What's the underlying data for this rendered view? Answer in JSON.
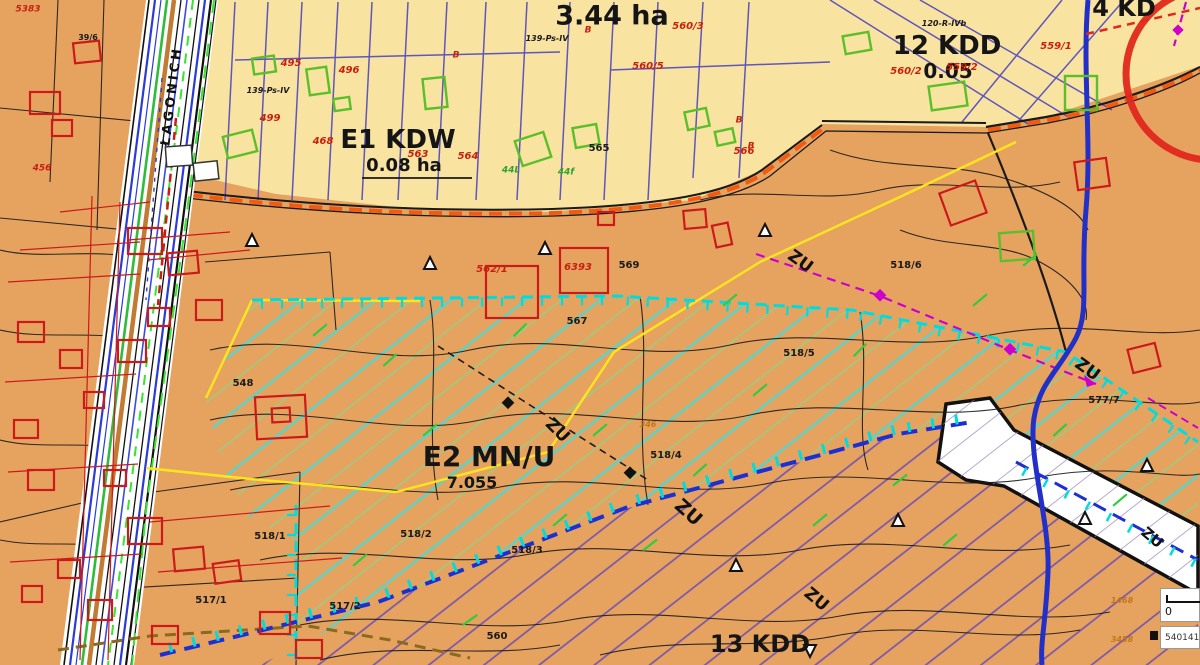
{
  "map_title": "zoning-plan-map",
  "colors": {
    "base_orange": "#E6A360",
    "zone_yellow": "#F8E3A0",
    "hatch_teal": "#5FD2C4",
    "hatch_green": "#8CD489",
    "hatch_purple": "#7B57A8",
    "boundary_yellow": "#FFE51E",
    "dashed_cyan": "#00DCDC",
    "dashed_blue": "#1D2FD0",
    "magenta": "#CC00CC",
    "river_blue": "#2230C8",
    "road_orange_dash": "#F25A10",
    "building_red": "#CC1A1A",
    "building_green": "#5BBF2A",
    "parcel_indigo": "#4F46C0",
    "road_green": "#2EBD3A",
    "road_brown": "#C27B32"
  },
  "scale_widget": {
    "zero": "0",
    "coordinate": "540141"
  },
  "labels": [
    {
      "name": "zone-label-344ha",
      "text": "3.44 ha",
      "x": 612,
      "y": 16,
      "size": 27,
      "color": "#151515",
      "weight": 700
    },
    {
      "name": "zone-label-12kdd",
      "text": "12 KDD",
      "x": 947,
      "y": 46,
      "size": 26,
      "color": "#151515",
      "weight": 700
    },
    {
      "name": "zone-label-12kdd-area",
      "text": "0.05",
      "x": 948,
      "y": 71,
      "size": 20,
      "color": "#151515",
      "weight": 700
    },
    {
      "name": "zone-label-e1kdw",
      "text": "E1 KDW",
      "x": 398,
      "y": 140,
      "size": 26,
      "color": "#151515",
      "weight": 700
    },
    {
      "name": "zone-label-e1kdw-area",
      "text": "0.08 ha",
      "x": 404,
      "y": 166,
      "size": 18,
      "color": "#151515",
      "weight": 700
    },
    {
      "name": "zone-label-e2mnu",
      "text": "E2 MN/U",
      "x": 489,
      "y": 457,
      "size": 28,
      "color": "#151515",
      "weight": 700
    },
    {
      "name": "zone-label-e2mnu-area",
      "text": "7.055",
      "x": 472,
      "y": 483,
      "size": 16,
      "color": "#151515",
      "weight": 700
    },
    {
      "name": "zone-label-13kdd",
      "text": "13 KDD",
      "x": 760,
      "y": 644,
      "size": 24,
      "color": "#151515",
      "weight": 700
    },
    {
      "name": "zone-label-4kd",
      "text": "4 KD",
      "x": 1124,
      "y": 8,
      "size": 24,
      "color": "#151515",
      "weight": 700
    },
    {
      "name": "zu-label",
      "text": "ZU",
      "x": 800,
      "y": 262,
      "size": 17,
      "color": "#111111",
      "weight": 700,
      "rot": 36
    },
    {
      "name": "zu-label",
      "text": "ZU",
      "x": 1087,
      "y": 370,
      "size": 17,
      "color": "#111111",
      "weight": 700,
      "rot": 36
    },
    {
      "name": "zu-label",
      "text": "ZU",
      "x": 557,
      "y": 431,
      "size": 17,
      "color": "#111111",
      "weight": 700,
      "rot": 45
    },
    {
      "name": "zu-label",
      "text": "ZU",
      "x": 688,
      "y": 513,
      "size": 19,
      "color": "#111111",
      "weight": 700,
      "rot": 42
    },
    {
      "name": "zu-label",
      "text": "ZU",
      "x": 816,
      "y": 600,
      "size": 17,
      "color": "#111111",
      "weight": 700,
      "rot": 40
    },
    {
      "name": "zu-label",
      "text": "ZU",
      "x": 1152,
      "y": 538,
      "size": 15,
      "color": "#111111",
      "weight": 700,
      "rot": 40
    },
    {
      "name": "street-name",
      "text": "ŁAGONICH",
      "x": 172,
      "y": 96,
      "size": 13,
      "color": "#111111",
      "weight": 700,
      "rot": -83,
      "ls": 3
    },
    {
      "name": "parcel-label",
      "text": "560/3",
      "x": 688,
      "y": 27,
      "size": 10,
      "color": "#C82010",
      "italic": true,
      "weight": 600
    },
    {
      "name": "parcel-label",
      "text": "560/5",
      "x": 648,
      "y": 67,
      "size": 10,
      "color": "#C82010",
      "italic": true,
      "weight": 600
    },
    {
      "name": "parcel-label",
      "text": "559/1",
      "x": 1056,
      "y": 47,
      "size": 10,
      "color": "#C82010",
      "italic": true,
      "weight": 600
    },
    {
      "name": "parcel-label",
      "text": "559/2",
      "x": 962,
      "y": 68,
      "size": 10,
      "color": "#C82010",
      "italic": true,
      "weight": 600
    },
    {
      "name": "parcel-label",
      "text": "560/2",
      "x": 906,
      "y": 72,
      "size": 10,
      "color": "#C82010",
      "italic": true,
      "weight": 600
    },
    {
      "name": "parcel-label",
      "text": "563",
      "x": 418,
      "y": 155,
      "size": 10,
      "color": "#C82010",
      "italic": true,
      "weight": 600
    },
    {
      "name": "parcel-label",
      "text": "564",
      "x": 468,
      "y": 157,
      "size": 10,
      "color": "#C82010",
      "italic": true,
      "weight": 600
    },
    {
      "name": "parcel-label",
      "text": "566",
      "x": 744,
      "y": 152,
      "size": 10,
      "color": "#C82010",
      "italic": true,
      "weight": 600
    },
    {
      "name": "parcel-label",
      "text": "495",
      "x": 291,
      "y": 64,
      "size": 10,
      "color": "#C82010",
      "italic": true,
      "weight": 600
    },
    {
      "name": "parcel-label",
      "text": "496",
      "x": 349,
      "y": 71,
      "size": 10,
      "color": "#C82010",
      "italic": true,
      "weight": 600
    },
    {
      "name": "parcel-label",
      "text": "499",
      "x": 270,
      "y": 119,
      "size": 10,
      "color": "#C82010",
      "italic": true,
      "weight": 600
    },
    {
      "name": "parcel-label",
      "text": "468",
      "x": 323,
      "y": 142,
      "size": 10,
      "color": "#C82010",
      "italic": true,
      "weight": 600
    },
    {
      "name": "parcel-label",
      "text": "6393",
      "x": 578,
      "y": 268,
      "size": 10,
      "color": "#C82010",
      "italic": true,
      "weight": 600
    },
    {
      "name": "parcel-label",
      "text": "562/1",
      "x": 492,
      "y": 270,
      "size": 10,
      "color": "#C82010",
      "italic": true,
      "weight": 600
    },
    {
      "name": "parcel-label",
      "text": "5383",
      "x": 28,
      "y": 10,
      "size": 9,
      "color": "#C82010",
      "italic": true,
      "weight": 600
    },
    {
      "name": "parcel-label",
      "text": "456",
      "x": 42,
      "y": 169,
      "size": 9,
      "color": "#C82010",
      "italic": true,
      "weight": 600
    },
    {
      "name": "building-class-label",
      "text": "B",
      "x": 456,
      "y": 56,
      "size": 9,
      "color": "#C82010",
      "italic": true,
      "weight": 600
    },
    {
      "name": "building-class-label",
      "text": "B",
      "x": 588,
      "y": 31,
      "size": 9,
      "color": "#C82010",
      "italic": true,
      "weight": 600
    },
    {
      "name": "building-class-label",
      "text": "B",
      "x": 739,
      "y": 121,
      "size": 9,
      "color": "#C82010",
      "italic": true,
      "weight": 600
    },
    {
      "name": "building-class-label",
      "text": "B",
      "x": 751,
      "y": 147,
      "size": 9,
      "color": "#C82010",
      "italic": true,
      "weight": 600
    },
    {
      "name": "parcel-label",
      "text": "567",
      "x": 577,
      "y": 322,
      "size": 10,
      "color": "#1a1a1a",
      "weight": 700
    },
    {
      "name": "parcel-label",
      "text": "569",
      "x": 629,
      "y": 266,
      "size": 10,
      "color": "#1a1a1a",
      "weight": 700
    },
    {
      "name": "parcel-label",
      "text": "565",
      "x": 599,
      "y": 149,
      "size": 10,
      "color": "#1a1a1a",
      "weight": 700
    },
    {
      "name": "parcel-label",
      "text": "548",
      "x": 243,
      "y": 384,
      "size": 10,
      "color": "#1a1a1a",
      "weight": 700
    },
    {
      "name": "parcel-label",
      "text": "518/6",
      "x": 906,
      "y": 266,
      "size": 10,
      "color": "#1a1a1a",
      "weight": 700
    },
    {
      "name": "parcel-label",
      "text": "518/5",
      "x": 799,
      "y": 354,
      "size": 10,
      "color": "#1a1a1a",
      "weight": 700
    },
    {
      "name": "parcel-label",
      "text": "518/4",
      "x": 666,
      "y": 456,
      "size": 10,
      "color": "#1a1a1a",
      "weight": 700
    },
    {
      "name": "parcel-label",
      "text": "518/3",
      "x": 527,
      "y": 551,
      "size": 10,
      "color": "#1a1a1a",
      "weight": 700
    },
    {
      "name": "parcel-label",
      "text": "518/2",
      "x": 416,
      "y": 535,
      "size": 10,
      "color": "#1a1a1a",
      "weight": 700
    },
    {
      "name": "parcel-label",
      "text": "518/1",
      "x": 270,
      "y": 537,
      "size": 10,
      "color": "#1a1a1a",
      "weight": 700
    },
    {
      "name": "parcel-label",
      "text": "517/1",
      "x": 211,
      "y": 601,
      "size": 10,
      "color": "#1a1a1a",
      "weight": 700
    },
    {
      "name": "parcel-label",
      "text": "517/2",
      "x": 345,
      "y": 607,
      "size": 10,
      "color": "#1a1a1a",
      "weight": 700
    },
    {
      "name": "parcel-label",
      "text": "560",
      "x": 497,
      "y": 637,
      "size": 10,
      "color": "#1a1a1a",
      "weight": 700
    },
    {
      "name": "parcel-label",
      "text": "577/7",
      "x": 1104,
      "y": 401,
      "size": 10,
      "color": "#1a1a1a",
      "weight": 700
    },
    {
      "name": "parcel-label",
      "text": "39/6",
      "x": 88,
      "y": 38,
      "size": 8,
      "color": "#1a1a1a",
      "weight": 700
    },
    {
      "name": "soil-label",
      "text": "139-Ps-IV",
      "x": 268,
      "y": 91,
      "size": 8,
      "color": "#1a1a1a",
      "italic": true,
      "weight": 600
    },
    {
      "name": "soil-label",
      "text": "139-Ps-IV",
      "x": 547,
      "y": 39,
      "size": 8,
      "color": "#1a1a1a",
      "italic": true,
      "weight": 600
    },
    {
      "name": "soil-label",
      "text": "120-R-IVb",
      "x": 944,
      "y": 24,
      "size": 8,
      "color": "#1a1a1a",
      "italic": true,
      "weight": 600
    },
    {
      "name": "forest-label",
      "text": "44L",
      "x": 511,
      "y": 171,
      "size": 9,
      "color": "#2FA12F",
      "italic": true,
      "weight": 600
    },
    {
      "name": "forest-label",
      "text": "44f",
      "x": 566,
      "y": 173,
      "size": 9,
      "color": "#2FA12F",
      "italic": true,
      "weight": 600
    },
    {
      "name": "elevation-label",
      "text": "1468",
      "x": 1122,
      "y": 601,
      "size": 8,
      "color": "#C07818",
      "italic": true,
      "weight": 600
    },
    {
      "name": "elevation-label",
      "text": "3458",
      "x": 1122,
      "y": 640,
      "size": 8,
      "color": "#C07818",
      "italic": true,
      "weight": 600
    },
    {
      "name": "elevation-label",
      "text": "346",
      "x": 648,
      "y": 425,
      "size": 8,
      "color": "#C07818",
      "italic": true,
      "weight": 600
    }
  ]
}
